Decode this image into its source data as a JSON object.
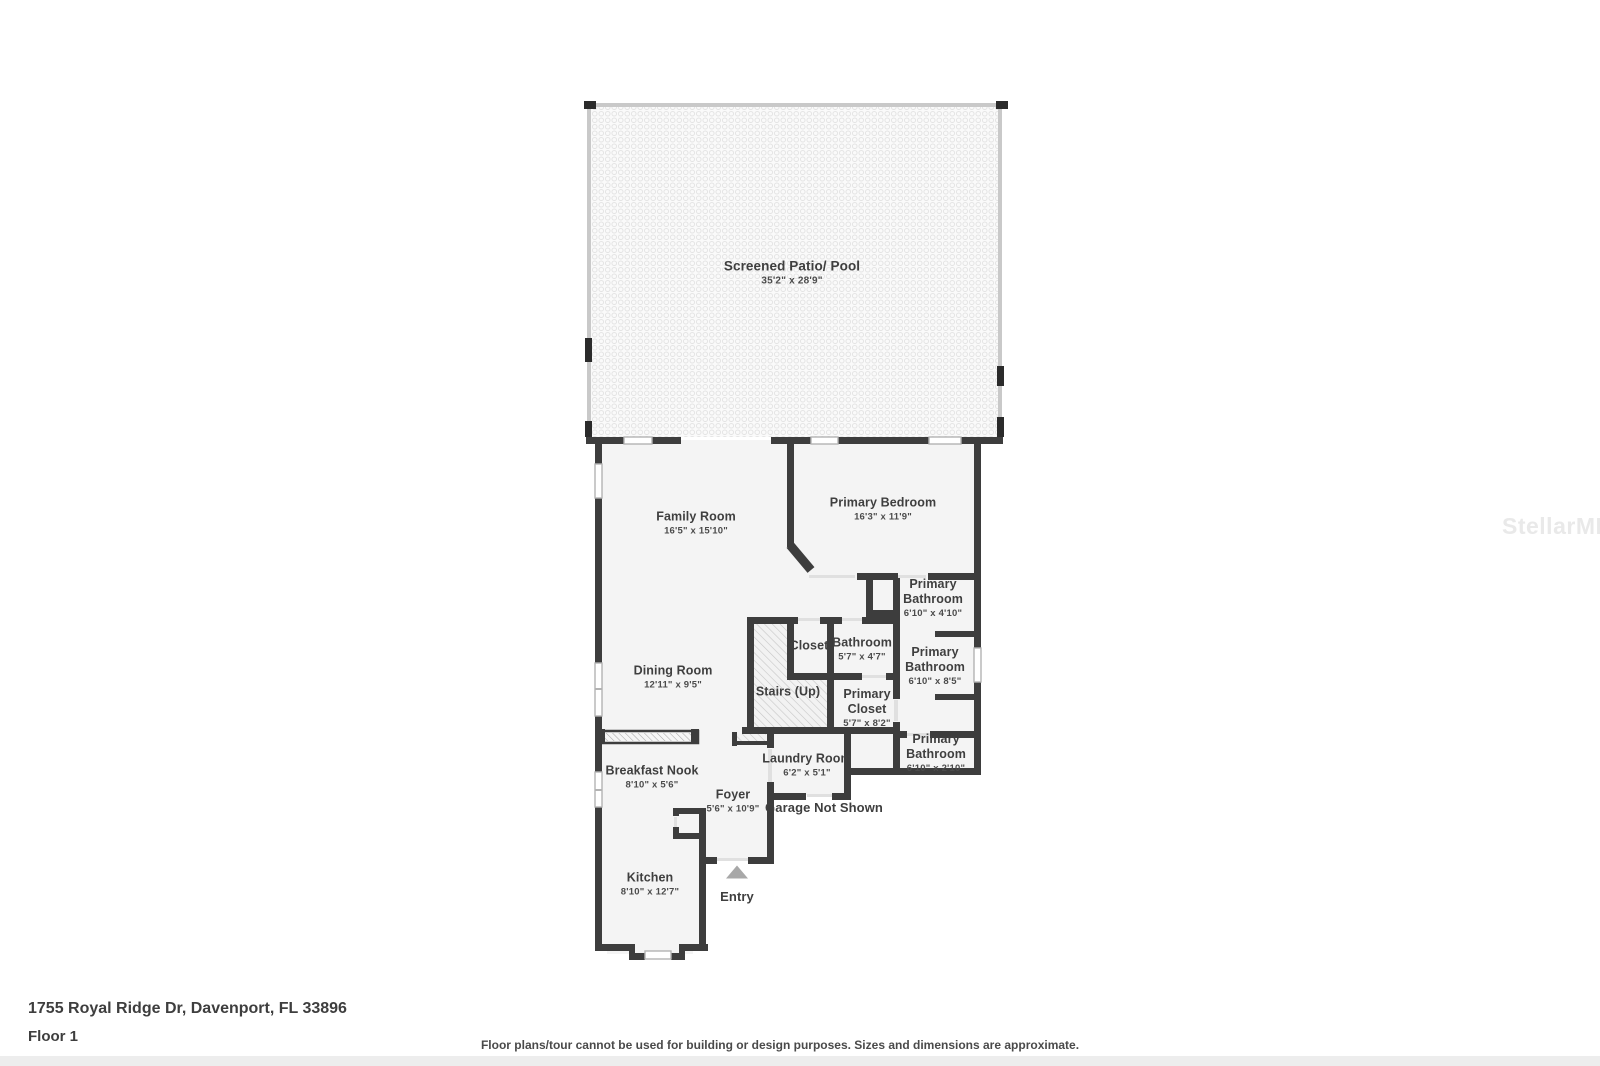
{
  "meta": {
    "address": "1755 Royal Ridge Dr, Davenport, FL 33896",
    "floor_label": "Floor 1",
    "disclaimer": "Floor plans/tour cannot be used for building or design purposes. Sizes and dimensions are approximate.",
    "watermark": "StellarMLS"
  },
  "colors": {
    "wall": "#3d3d3d",
    "floor": "#f4f4f4",
    "patio_screen": "#c9c9c9",
    "entry_marker": "#a8a8a8",
    "label_text": "#3f3f3f",
    "watermark_text": "#e9e9e9"
  },
  "rooms": [
    {
      "name": "Screened Patio/ Pool",
      "dims": "35'2\" x 28'9\""
    },
    {
      "name": "Family Room",
      "dims": "16'5\" x 15'10\""
    },
    {
      "name": "Primary Bedroom",
      "dims": "16'3\" x 11'9\""
    },
    {
      "name": "Primary Bathroom",
      "dims": "6'10\" x 4'10\""
    },
    {
      "name": "Bathroom",
      "dims": "5'7\" x 4'7\""
    },
    {
      "name": "Closet",
      "dims": ""
    },
    {
      "name": "Primary Bathroom",
      "dims": "6'10\" x 8'5\""
    },
    {
      "name": "Dining Room",
      "dims": "12'11\" x 9'5\""
    },
    {
      "name": "Stairs (Up)",
      "dims": ""
    },
    {
      "name": "Primary Closet",
      "dims": "5'7\" x 8'2\""
    },
    {
      "name": "Primary Bathroom",
      "dims": "6'10\" x 2'10\""
    },
    {
      "name": "Laundry Room",
      "dims": "6'2\" x 5'1\""
    },
    {
      "name": "Breakfast Nook",
      "dims": "8'10\" x 5'6\""
    },
    {
      "name": "Foyer",
      "dims": "5'6\" x 10'9\""
    },
    {
      "name": "Garage Not Shown",
      "dims": ""
    },
    {
      "name": "Kitchen",
      "dims": "8'10\" x 12'7\""
    },
    {
      "name": "Entry",
      "dims": ""
    }
  ]
}
